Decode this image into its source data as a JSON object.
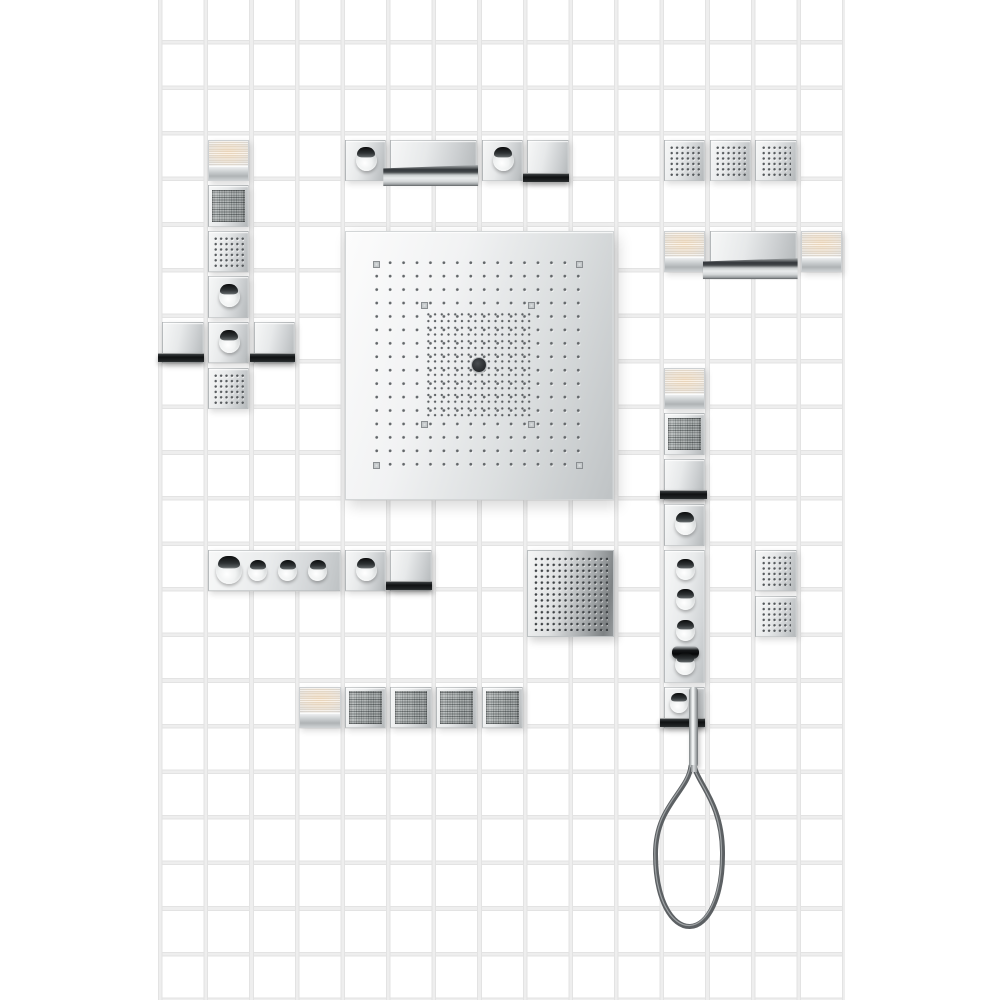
{
  "scene": {
    "description": "Product photograph: modular shower collection components arranged on a white tiled wall",
    "wall": {
      "tile_color": "#ffffff",
      "grout_color": "#e6e6e6"
    },
    "palette": {
      "chrome_light": "#f6f7f7",
      "chrome_mid": "#e0e2e3",
      "chrome_dark": "#b4b8ba",
      "shelf_black": "#141617",
      "lamp_glow_warm": "#f6e0c2",
      "speaker_mesh": "#8d9393",
      "nozzle_dot": "#54585b",
      "hose_gray": "#5c6063"
    },
    "components": [
      {
        "name": "rain-showerhead",
        "count": 1,
        "detail": "large square overhead panel, fine nozzle grid, dense center field, central body jet"
      },
      {
        "name": "spray-plate",
        "count": 1,
        "detail": "square spray plate with 13x13 nozzle grid"
      },
      {
        "name": "spray-module",
        "count": 7,
        "detail": "single-tile module with 6x6 spray nozzles"
      },
      {
        "name": "light-module",
        "count": 5,
        "detail": "single-tile module with warm frosted light panel and chrome base"
      },
      {
        "name": "speaker-module",
        "count": 6,
        "detail": "single-tile module with woven loudspeaker grille"
      },
      {
        "name": "valve-module",
        "count": 6,
        "detail": "single-tile module with round shut-off handle"
      },
      {
        "name": "spout-module",
        "count": 5,
        "detail": "single-tile module with dark spout shelf"
      },
      {
        "name": "spout-panel",
        "count": 2,
        "detail": "double-width panel with waterfall spout shelf"
      },
      {
        "name": "thermostat-panel-horizontal",
        "count": 1,
        "detail": "triple-width panel with four round handles"
      },
      {
        "name": "thermostat-panel-vertical",
        "count": 1,
        "detail": "triple-height panel with three handles and thermostat grip"
      },
      {
        "name": "hand-shower-module",
        "count": 1,
        "detail": "holder module with baton hand shower and looped hose"
      }
    ]
  }
}
